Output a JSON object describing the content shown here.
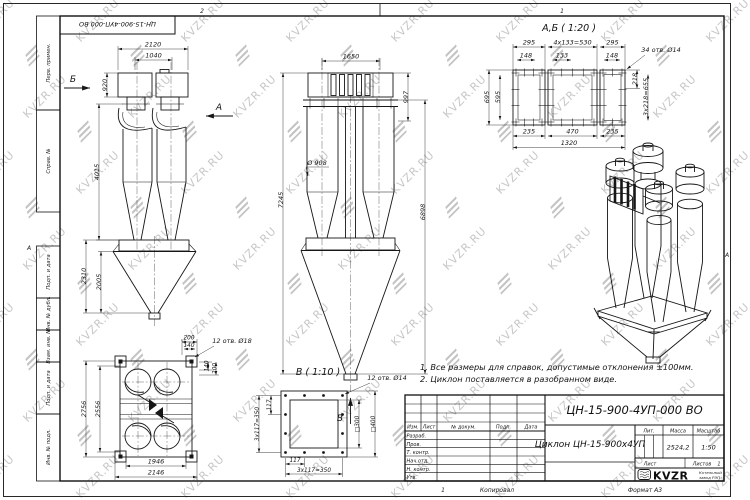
{
  "watermark": {
    "text": "KVZR.RU"
  },
  "frame": {
    "zone2": "2",
    "zone1": "1",
    "zone_letter_left": "А",
    "zone_letter_right": "А",
    "stamp": "ЦН-15-900-4УП-000 ВО",
    "labels": [
      "Перв. примен.",
      "Справ. №",
      "Подп. и дата",
      "Инв. № дубл.",
      "Взам. инв. №",
      "Подп. и дата",
      "Инв. № подл."
    ],
    "bottom_num": "1",
    "copied": "Копировал",
    "format": "Формат А3"
  },
  "notes": [
    "1. Все размеры для справок, допустимые отклонения ±100мм.",
    "2. Циклон поставляется в разобранном виде."
  ],
  "views": {
    "side": {
      "arrow_b": "Б",
      "arrow_a": "А",
      "dim_w": "2120",
      "dim_w2": "1040",
      "dim_h_in": "920",
      "dim_h_body": "4015",
      "dim_h_hop": "2310",
      "dim_h_hop2": "2005"
    },
    "front": {
      "arrow_v": "В",
      "dim_w": "1650",
      "dim_h_in": "997",
      "dim_h_total": "7245",
      "dim_h_right": "6898",
      "dia": "Ø 908"
    },
    "ab": {
      "title": "А,Б ( 1:20 )",
      "t1": "295",
      "t2": "4x133=530",
      "t3": "295",
      "s1": "148",
      "s2": "133",
      "s3": "148",
      "holes": "34 отв. Ø14",
      "l1": "695",
      "l2": "595",
      "r1": "218",
      "r2": "3x218=655",
      "b1": "235",
      "b2": "470",
      "b3": "235",
      "b4": "1320"
    },
    "plan": {
      "d1": "200",
      "d2": "140",
      "holes": "12 отв. Ø18",
      "r1": "140",
      "r2": "200",
      "l1": "2756",
      "l2": "2556",
      "b1": "1946",
      "b2": "2146"
    },
    "v": {
      "title": "В ( 1:10 )",
      "holes": "12 отв. Ø14",
      "l1": "117",
      "l2": "3x117=350",
      "b1": "117",
      "b2": "3x117=350",
      "sq_in": "□300",
      "sq_out": "□400"
    }
  },
  "title_block": {
    "designation": "ЦН-15-900-4УП-000 ВО",
    "name": "Циклон ЦН-15-900х4УП",
    "col_izm": "Изм.",
    "col_list": "Лист",
    "col_doc": "№ докум.",
    "col_sign": "Подп.",
    "col_date": "Дата",
    "rows": [
      "Разраб.",
      "Пров.",
      "Т. контр.",
      "Нач.отд.",
      "Н. контр.",
      "Утв."
    ],
    "lit": "Лит.",
    "mass": "Масса",
    "scale": "Масштаб",
    "mass_value": "2524,2",
    "scale_value": "1:50",
    "sheet": "Лист",
    "sheets": "Листов",
    "sheets_value": "1",
    "logo": "KVZR",
    "logo_sub1": "Котельный",
    "logo_sub2": "завод РЭП"
  }
}
